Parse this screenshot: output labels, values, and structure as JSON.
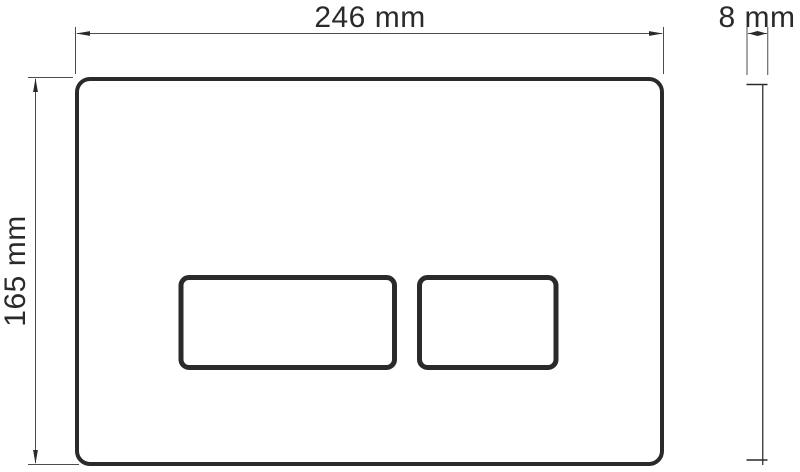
{
  "drawing": {
    "labels": {
      "plate_width": "246 mm",
      "plate_thickness": "8 mm",
      "plate_height": "165 mm"
    },
    "colors": {
      "outline": "#2b2a29",
      "dimension": "#4c4c4c",
      "background": "#ffffff"
    }
  }
}
